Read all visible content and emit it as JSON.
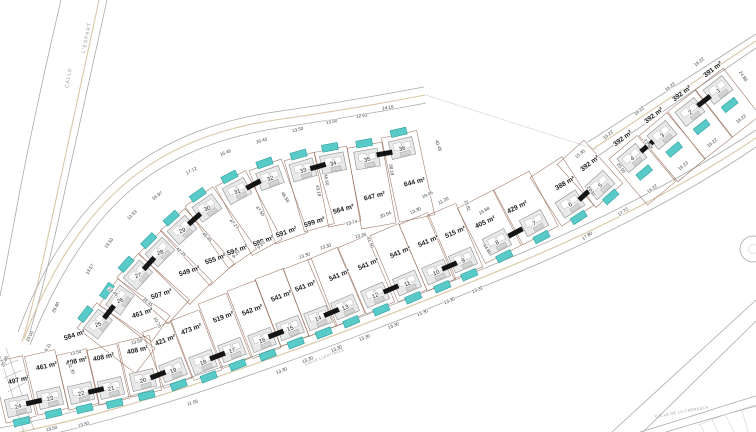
{
  "units": {
    "area_suffix": " m²"
  },
  "colors": {
    "pool": "#58cbc9",
    "parcel_line": "#8a5a43",
    "road_line": "#a9a9a9",
    "curb": "#d8c7a6",
    "party_wall": "#151515",
    "dim_text": "#3c3c3c",
    "area_text": "#1c1c1c"
  },
  "roads": {
    "espart_word1": "CALLE",
    "espart_word2": "L'ESPART",
    "llentiscle": "CALLE LLENTISCLE",
    "carrasca": "CALLE DE LA CARRASCA"
  },
  "plots": [
    {
      "n": "1",
      "a": "391",
      "x": 718,
      "y": 90,
      "hr": -38,
      "t": 52,
      "L": 46,
      "w": 35,
      "ps": 1,
      "lx": 714,
      "ly": 71,
      "lr": -38
    },
    {
      "n": "2",
      "a": "392",
      "x": 690,
      "y": 112,
      "hr": -38,
      "t": 52,
      "L": 46,
      "w": 35,
      "ps": 1,
      "lx": 683,
      "ly": 95,
      "lr": -38
    },
    {
      "n": "3",
      "a": "392",
      "x": 662,
      "y": 135,
      "hr": -40,
      "t": 50,
      "L": 46,
      "w": 36,
      "ps": 1,
      "lx": 655,
      "ly": 117,
      "lr": -38
    },
    {
      "n": "4",
      "a": "392",
      "x": 632,
      "y": 158,
      "hr": -40,
      "t": 50,
      "L": 46,
      "w": 37,
      "ps": 1,
      "lx": 624,
      "ly": 140,
      "lr": -38
    },
    {
      "n": "5",
      "a": "392",
      "x": 600,
      "y": 185,
      "hr": -42,
      "t": -132,
      "L": 44,
      "w": 36,
      "ps": -1,
      "lx": 591,
      "ly": 165,
      "lr": -38
    },
    {
      "n": "6",
      "a": "388",
      "x": 570,
      "y": 204,
      "hr": -33,
      "t": -123,
      "L": 44,
      "w": 38,
      "ps": -1,
      "lx": 566,
      "ly": 185,
      "lr": -30
    },
    {
      "n": "7",
      "a": "429",
      "x": 534,
      "y": 223,
      "hr": -28,
      "t": -118,
      "L": 48,
      "w": 40,
      "ps": -1,
      "lx": 518,
      "ly": 209,
      "lr": -26
    },
    {
      "n": "8",
      "a": "405",
      "x": 497,
      "y": 242,
      "hr": -27,
      "t": -117,
      "L": 48,
      "w": 40,
      "ps": -1,
      "lx": 486,
      "ly": 224,
      "lr": -25
    },
    {
      "n": "9",
      "a": "515",
      "x": 463,
      "y": 260,
      "hr": -23,
      "t": -113,
      "L": 55,
      "w": 31,
      "ps": -1,
      "lx": 456,
      "ly": 234,
      "lr": -23
    },
    {
      "n": "10",
      "a": "541",
      "x": 436,
      "y": 272,
      "hr": -23,
      "t": -113,
      "L": 58,
      "w": 31,
      "ps": -1,
      "lx": 429,
      "ly": 243,
      "lr": -23
    },
    {
      "n": "11",
      "a": "541",
      "x": 407,
      "y": 283,
      "hr": -23,
      "t": -113,
      "L": 58,
      "w": 31,
      "ps": -1,
      "lx": 401,
      "ly": 254,
      "lr": -23
    },
    {
      "n": "12",
      "a": "541",
      "x": 375,
      "y": 295,
      "hr": -23,
      "t": -113,
      "L": 58,
      "w": 31,
      "ps": -1,
      "lx": 369,
      "ly": 266,
      "lr": -23
    },
    {
      "n": "13",
      "a": "541",
      "x": 345,
      "y": 307,
      "hr": -23,
      "t": -113,
      "L": 58,
      "w": 32,
      "ps": -1,
      "lx": 340,
      "ly": 277,
      "lr": -23
    },
    {
      "n": "14",
      "a": "541",
      "x": 318,
      "y": 318,
      "hr": -21,
      "t": -111,
      "L": 58,
      "w": 30,
      "ps": -1,
      "lx": 306,
      "ly": 288,
      "lr": -21
    },
    {
      "n": "15",
      "a": "541",
      "x": 290,
      "y": 328,
      "hr": -21,
      "t": -111,
      "L": 58,
      "w": 30,
      "ps": -1,
      "lx": 282,
      "ly": 298,
      "lr": -21
    },
    {
      "n": "16",
      "a": "542",
      "x": 262,
      "y": 340,
      "hr": -21,
      "t": -111,
      "L": 58,
      "w": 30,
      "ps": -1,
      "lx": 253,
      "ly": 312,
      "lr": -21
    },
    {
      "n": "17",
      "a": "519",
      "x": 232,
      "y": 350,
      "hr": -21,
      "t": -111,
      "L": 55,
      "w": 30,
      "ps": -1,
      "lx": 224,
      "ly": 319,
      "lr": -21
    },
    {
      "n": "18",
      "a": "473",
      "x": 203,
      "y": 362,
      "hr": -21,
      "t": -111,
      "L": 50,
      "w": 30,
      "ps": -1,
      "lx": 192,
      "ly": 331,
      "lr": -21
    },
    {
      "n": "19",
      "a": "421",
      "x": 173,
      "y": 370,
      "hr": -21,
      "t": -111,
      "L": 46,
      "w": 30,
      "ps": -1,
      "lx": 166,
      "ly": 342,
      "lr": -21
    },
    {
      "n": "20",
      "a": "408",
      "x": 143,
      "y": 380,
      "hr": -13,
      "t": -103,
      "L": 42,
      "w": 32,
      "ps": -1,
      "lx": 138,
      "ly": 352,
      "lr": -13
    },
    {
      "n": "21",
      "a": "408",
      "x": 111,
      "y": 388,
      "hr": -13,
      "t": -103,
      "L": 42,
      "w": 31,
      "ps": -1,
      "lx": 104,
      "ly": 359,
      "lr": -13
    },
    {
      "n": "22",
      "a": "408",
      "x": 81,
      "y": 393,
      "hr": -13,
      "t": -103,
      "L": 42,
      "w": 31,
      "ps": -1,
      "lx": 77,
      "ly": 363,
      "lr": -13
    },
    {
      "n": "23",
      "a": "461",
      "x": 50,
      "y": 398,
      "hr": -13,
      "t": -103,
      "L": 46,
      "w": 31,
      "ps": -1,
      "lx": 47,
      "ly": 368,
      "lr": -13
    },
    {
      "n": "24",
      "a": "497",
      "x": 18,
      "y": 406,
      "hr": -13,
      "t": -103,
      "L": 48,
      "w": 31,
      "ps": -1,
      "lx": 19,
      "ly": 382,
      "lr": -13
    },
    {
      "n": "25",
      "a": "584",
      "x": 98,
      "y": 324,
      "hr": -52,
      "t": 38,
      "L": 60,
      "w": 32,
      "ps": -1,
      "lx": 75,
      "ly": 337,
      "lr": -18
    },
    {
      "n": "26",
      "a": "461",
      "x": 120,
      "y": 300,
      "hr": -55,
      "t": 35,
      "L": 50,
      "w": 32,
      "ps": -1,
      "lx": 143,
      "ly": 315,
      "lr": -18
    },
    {
      "n": "27",
      "a": "507",
      "x": 138,
      "y": 275,
      "hr": -48,
      "t": 42,
      "L": 55,
      "w": 32,
      "ps": -1,
      "lx": 162,
      "ly": 296,
      "lr": -18
    },
    {
      "n": "28",
      "a": "549",
      "x": 160,
      "y": 252,
      "hr": -45,
      "t": 45,
      "L": 58,
      "w": 32,
      "ps": -1,
      "lx": 190,
      "ly": 273,
      "lr": -18
    },
    {
      "n": "29",
      "a": "555",
      "x": 182,
      "y": 230,
      "hr": -42,
      "t": 48,
      "L": 60,
      "w": 33,
      "ps": -1,
      "lx": 216,
      "ly": 261,
      "lr": -20
    },
    {
      "n": "30",
      "a": "594",
      "x": 207,
      "y": 208,
      "hr": -35,
      "t": 55,
      "L": 62,
      "w": 34,
      "ps": -1,
      "lx": 238,
      "ly": 252,
      "lr": -20
    },
    {
      "n": "31",
      "a": "598",
      "x": 237,
      "y": 191,
      "hr": -28,
      "t": 62,
      "L": 64,
      "w": 34,
      "ps": -1,
      "lx": 264,
      "ly": 243,
      "lr": -20
    },
    {
      "n": "32",
      "a": "591",
      "x": 270,
      "y": 178,
      "hr": -20,
      "t": 70,
      "L": 64,
      "w": 34,
      "ps": -1,
      "lx": 287,
      "ly": 234,
      "lr": -20
    },
    {
      "n": "33",
      "a": "599",
      "x": 303,
      "y": 170,
      "hr": -16,
      "t": 74,
      "L": 60,
      "w": 31,
      "ps": -1,
      "lx": 315,
      "ly": 224,
      "lr": -18
    },
    {
      "n": "34",
      "a": "564",
      "x": 333,
      "y": 163,
      "hr": -11,
      "t": 79,
      "L": 62,
      "w": 33,
      "ps": -1,
      "lx": 344,
      "ly": 211,
      "lr": -16
    },
    {
      "n": "35",
      "a": "647",
      "x": 367,
      "y": 159,
      "hr": -10,
      "t": 80,
      "L": 68,
      "w": 35,
      "ps": -1,
      "lx": 375,
      "ly": 198,
      "lr": -14
    },
    {
      "n": "36",
      "a": "644",
      "x": 402,
      "y": 148,
      "hr": -13,
      "t": 78,
      "L": 72,
      "w": 36,
      "ps": -1,
      "lx": 415,
      "ly": 184,
      "lr": -14
    }
  ],
  "dimensions": [
    {
      "v": "16.40",
      "x": 262,
      "y": 142,
      "r": -16
    },
    {
      "v": "16.46",
      "x": 226,
      "y": 154,
      "r": -20
    },
    {
      "v": "17.12",
      "x": 192,
      "y": 172,
      "r": -28
    },
    {
      "v": "16.97",
      "x": 158,
      "y": 197,
      "r": -36
    },
    {
      "v": "13.53",
      "x": 133,
      "y": 216,
      "r": -44
    },
    {
      "v": "13.50",
      "x": 110,
      "y": 244,
      "r": -52
    },
    {
      "v": "13.57",
      "x": 91,
      "y": 270,
      "r": -58
    },
    {
      "v": "29.80",
      "x": 57,
      "y": 308,
      "r": -64
    },
    {
      "v": "10.00",
      "x": 31,
      "y": 337,
      "r": -62
    },
    {
      "v": "9.11",
      "x": 49,
      "y": 348,
      "r": -62
    },
    {
      "v": "20.80",
      "x": 6,
      "y": 362,
      "r": -66
    },
    {
      "v": "13.50",
      "x": 298,
      "y": 131,
      "r": -13
    },
    {
      "v": "13.50",
      "x": 332,
      "y": 123,
      "r": -11
    },
    {
      "v": "12.61",
      "x": 362,
      "y": 117,
      "r": -9
    },
    {
      "v": "14.19",
      "x": 388,
      "y": 109,
      "r": -7
    },
    {
      "v": "40.48",
      "x": 437,
      "y": 146,
      "r": 70
    },
    {
      "v": "19.45",
      "x": 428,
      "y": 196,
      "r": -26
    },
    {
      "v": "11.20",
      "x": 444,
      "y": 202,
      "r": -26
    },
    {
      "v": "15.81",
      "x": 466,
      "y": 206,
      "r": 72
    },
    {
      "v": "15.68",
      "x": 485,
      "y": 212,
      "r": -30
    },
    {
      "v": "13.30",
      "x": 416,
      "y": 212,
      "r": -24
    },
    {
      "v": "20.54",
      "x": 386,
      "y": 216,
      "r": -22
    },
    {
      "v": "38.18",
      "x": 390,
      "y": 170,
      "r": 80
    },
    {
      "v": "46.60",
      "x": 325,
      "y": 180,
      "r": 80
    },
    {
      "v": "43.18",
      "x": 317,
      "y": 191,
      "r": 78
    },
    {
      "v": "46.58",
      "x": 284,
      "y": 198,
      "r": 58
    },
    {
      "v": "47.55",
      "x": 259,
      "y": 212,
      "r": 52
    },
    {
      "v": "47.27",
      "x": 233,
      "y": 225,
      "r": 48
    },
    {
      "v": "45.45",
      "x": 206,
      "y": 238,
      "r": 45
    },
    {
      "v": "42.25",
      "x": 180,
      "y": 253,
      "r": 42
    },
    {
      "v": "9.20",
      "x": 237,
      "y": 255,
      "r": -48
    },
    {
      "v": "9.20",
      "x": 262,
      "y": 246,
      "r": -44
    },
    {
      "v": "13.30",
      "x": 305,
      "y": 257,
      "r": -18
    },
    {
      "v": "13.30",
      "x": 326,
      "y": 248,
      "r": -17
    },
    {
      "v": "13.74",
      "x": 352,
      "y": 224,
      "r": -14
    },
    {
      "v": "13.35",
      "x": 361,
      "y": 237,
      "r": -14
    },
    {
      "v": "41.50",
      "x": 369,
      "y": 243,
      "r": 66
    },
    {
      "v": "44.80",
      "x": 486,
      "y": 250,
      "r": 56
    },
    {
      "v": "15.35",
      "x": 581,
      "y": 155,
      "r": -40
    },
    {
      "v": "25.05",
      "x": 620,
      "y": 169,
      "r": 54
    },
    {
      "v": "24.35",
      "x": 590,
      "y": 192,
      "r": 54
    },
    {
      "v": "23.68",
      "x": 647,
      "y": 145,
      "r": 52
    },
    {
      "v": "16.22",
      "x": 609,
      "y": 136,
      "r": -38
    },
    {
      "v": "16.22",
      "x": 640,
      "y": 112,
      "r": -38
    },
    {
      "v": "16.22",
      "x": 671,
      "y": 88,
      "r": -38
    },
    {
      "v": "16.22",
      "x": 700,
      "y": 63,
      "r": -38
    },
    {
      "v": "24.88",
      "x": 742,
      "y": 77,
      "r": 55
    },
    {
      "v": "16.22",
      "x": 742,
      "y": 120,
      "r": -38
    },
    {
      "v": "16.22",
      "x": 713,
      "y": 144,
      "r": -38
    },
    {
      "v": "16.23",
      "x": 684,
      "y": 167,
      "r": -38
    },
    {
      "v": "16.22",
      "x": 653,
      "y": 190,
      "r": -38
    },
    {
      "v": "17.72",
      "x": 624,
      "y": 213,
      "r": -36
    },
    {
      "v": "17.80",
      "x": 588,
      "y": 237,
      "r": -34
    },
    {
      "v": "13.32",
      "x": 478,
      "y": 291,
      "r": -24
    },
    {
      "v": "13.30",
      "x": 450,
      "y": 302,
      "r": -24
    },
    {
      "v": "13.30",
      "x": 423,
      "y": 314,
      "r": -23
    },
    {
      "v": "13.30",
      "x": 394,
      "y": 327,
      "r": -22
    },
    {
      "v": "13.30",
      "x": 365,
      "y": 339,
      "r": -21
    },
    {
      "v": "13.30",
      "x": 337,
      "y": 350,
      "r": -21
    },
    {
      "v": "13.30",
      "x": 308,
      "y": 361,
      "r": -20
    },
    {
      "v": "13.30",
      "x": 282,
      "y": 372,
      "r": -20
    },
    {
      "v": "11.55",
      "x": 193,
      "y": 404,
      "r": -18
    },
    {
      "v": "13.50",
      "x": 137,
      "y": 343,
      "r": -15
    },
    {
      "v": "13.50",
      "x": 76,
      "y": 354,
      "r": -14
    },
    {
      "v": "31.30",
      "x": 70,
      "y": 369,
      "r": 68
    },
    {
      "v": "13.50",
      "x": 84,
      "y": 426,
      "r": -17
    },
    {
      "v": "13.50",
      "x": 52,
      "y": 430,
      "r": -14
    },
    {
      "v": "10.70",
      "x": 156,
      "y": 323,
      "r": 62
    },
    {
      "v": "35.35",
      "x": 147,
      "y": 303,
      "r": 40
    },
    {
      "v": "33.45",
      "x": 112,
      "y": 293,
      "r": 38
    }
  ]
}
